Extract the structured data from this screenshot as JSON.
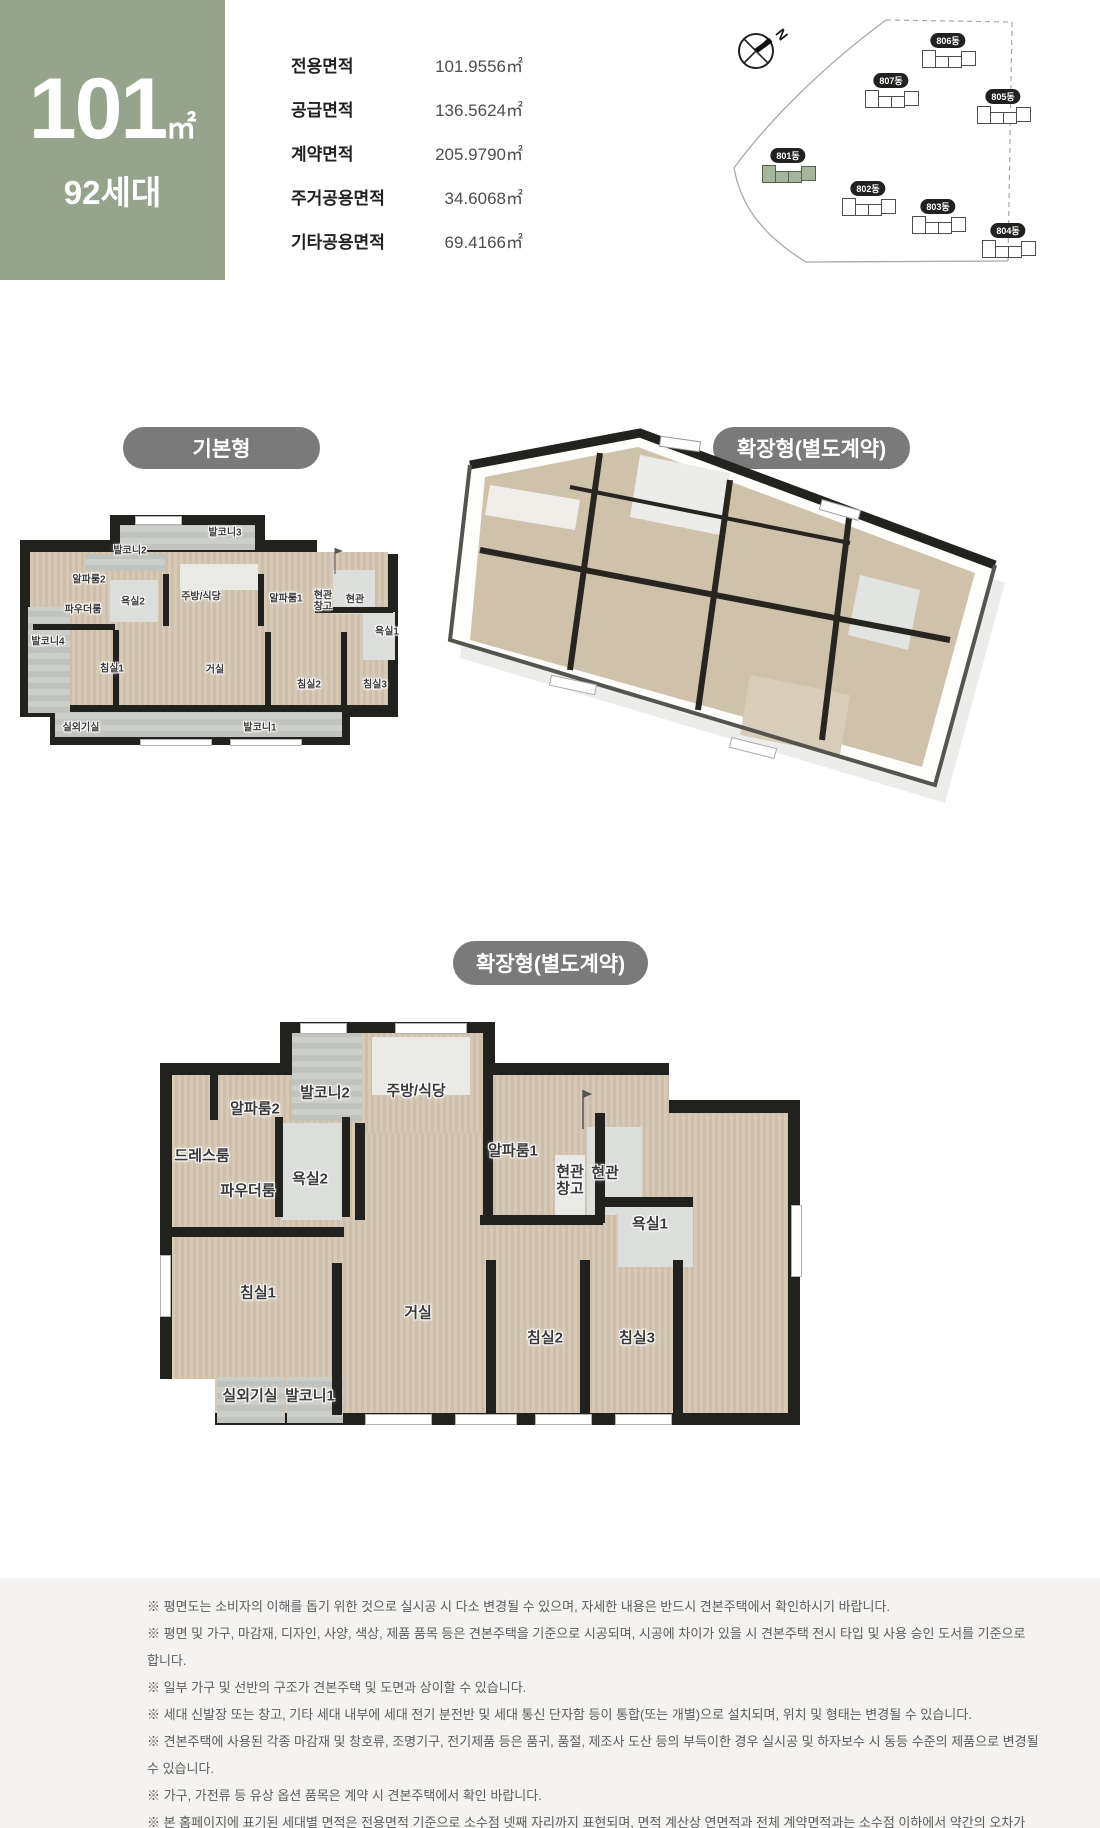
{
  "header": {
    "area_code": "101",
    "area_unit": "㎡",
    "households": "92세대",
    "green_color": "#95a48b",
    "area_table": {
      "rows": [
        {
          "label": "전용면적",
          "value": "101.9556㎡"
        },
        {
          "label": "공급면적",
          "value": "136.5624㎡"
        },
        {
          "label": "계약면적",
          "value": "205.9790㎡"
        },
        {
          "label": "주거공용면적",
          "value": "34.6068㎡"
        },
        {
          "label": "기타공용면적",
          "value": "69.4166㎡"
        }
      ]
    }
  },
  "site_plan": {
    "compass_label": "N",
    "highlight_color": "#a5b69b",
    "buildings": [
      {
        "name": "806동",
        "x": 300,
        "y": 28
      },
      {
        "name": "807동",
        "x": 243,
        "y": 68
      },
      {
        "name": "805동",
        "x": 355,
        "y": 84
      },
      {
        "name": "801동",
        "x": 140,
        "y": 143,
        "highlighted": true
      },
      {
        "name": "802동",
        "x": 220,
        "y": 176
      },
      {
        "name": "803동",
        "x": 290,
        "y": 194
      },
      {
        "name": "804동",
        "x": 360,
        "y": 218
      }
    ]
  },
  "sections": {
    "basic_badge": "기본형",
    "extended_badge": "확장형(별도계약)",
    "extended_plan_badge": "확장형(별도계약)"
  },
  "basic_plan": {
    "rooms": [
      {
        "name": "발코니3",
        "x": 210,
        "y": 19
      },
      {
        "name": "발코니2",
        "x": 115,
        "y": 37
      },
      {
        "name": "알파룸2",
        "x": 74,
        "y": 66
      },
      {
        "name": "주방/식당",
        "x": 186,
        "y": 83
      },
      {
        "name": "욕실2",
        "x": 118,
        "y": 88
      },
      {
        "name": "파우더룸",
        "x": 68,
        "y": 96
      },
      {
        "name": "알파룸1",
        "x": 271,
        "y": 85
      },
      {
        "name": "현관",
        "x": 308,
        "y": 82
      },
      {
        "name": "창고",
        "x": 308,
        "y": 93
      },
      {
        "name": "현관",
        "x": 340,
        "y": 86
      },
      {
        "name": "욕실1",
        "x": 372,
        "y": 118
      },
      {
        "name": "발코니4",
        "x": 33,
        "y": 128
      },
      {
        "name": "침실1",
        "x": 97,
        "y": 155
      },
      {
        "name": "거실",
        "x": 200,
        "y": 156
      },
      {
        "name": "침실2",
        "x": 294,
        "y": 171
      },
      {
        "name": "침실3",
        "x": 360,
        "y": 171
      },
      {
        "name": "실외기실",
        "x": 66,
        "y": 214
      },
      {
        "name": "발코니1",
        "x": 245,
        "y": 214
      }
    ]
  },
  "extended_plan": {
    "rooms": [
      {
        "name": "발코니2",
        "x": 175,
        "y": 87
      },
      {
        "name": "주방/식당",
        "x": 266,
        "y": 85
      },
      {
        "name": "알파룸2",
        "x": 105,
        "y": 103
      },
      {
        "name": "드레스룸",
        "x": 52,
        "y": 150
      },
      {
        "name": "욕실2",
        "x": 160,
        "y": 173
      },
      {
        "name": "파우더룸",
        "x": 98,
        "y": 185
      },
      {
        "name": "알파룸1",
        "x": 363,
        "y": 145
      },
      {
        "name": "현관",
        "x": 420,
        "y": 166
      },
      {
        "name": "창고",
        "x": 420,
        "y": 183
      },
      {
        "name": "현관",
        "x": 455,
        "y": 167
      },
      {
        "name": "욕실1",
        "x": 500,
        "y": 218
      },
      {
        "name": "침실1",
        "x": 108,
        "y": 287
      },
      {
        "name": "거실",
        "x": 268,
        "y": 307
      },
      {
        "name": "침실2",
        "x": 395,
        "y": 332
      },
      {
        "name": "침실3",
        "x": 487,
        "y": 332
      },
      {
        "name": "실외기실",
        "x": 100,
        "y": 390
      },
      {
        "name": "발코니1",
        "x": 160,
        "y": 390
      }
    ]
  },
  "footer": {
    "lines": [
      {
        "text": "※ 평면도는 소비자의 이해를 돕기 위한 것으로 실시공 시 다소 변경될 수 있으며, 자세한 내용은 반드시 견본주택에서 확인하시기 바랍니다."
      },
      {
        "text": "※ 평면 및 가구, 마감재, 디자인, 사양, 색상, 제품 품목 등은 견본주택을 기준으로 시공되며, 시공에 차이가 있을 시 견본주택 전시 타입 및 사용 승인 도서를 기준으로 합니다."
      },
      {
        "text": "※ 일부 가구 및 선반의 구조가 견본주택 및 도면과 상이할 수 있습니다."
      },
      {
        "text": "※ 세대 신발장 또는 창고, 기타 세대 내부에 세대 전기 분전반 및 세대 통신 단자함 등이 통합(또는 개별)으로 설치되며, 위치 및 형태는 변경될 수 있습니다."
      },
      {
        "text": "※ 견본주택에 사용된 각종 마감재 및 창호류, 조명기구, 전기제품 등은 품귀, 품절, 제조사 도산 등의 부득이한 경우 실시공 및 하자보수 시 동등 수준의 제품으로 변경될 수 있습니다."
      },
      {
        "text": "※ 가구, 가전류 등 유상 옵션 품목은 계약 시 견본주택에서 확인 바랍니다."
      },
      {
        "text": "※ 본 홈페이지에 표기된 세대별 면적은 전용면적 기준으로 소수점 넷째 자리까지 표현되며, 면적 계산상 연면적과 전체 계약면적과는 소수점 이하에서 약간의 오차가 생길 수 있으며,"
      },
      {
        "text": "면적은 사업계획 승인 변경 등으로 실시공 시 변경될 수 있습니다.",
        "indent": true
      }
    ]
  }
}
